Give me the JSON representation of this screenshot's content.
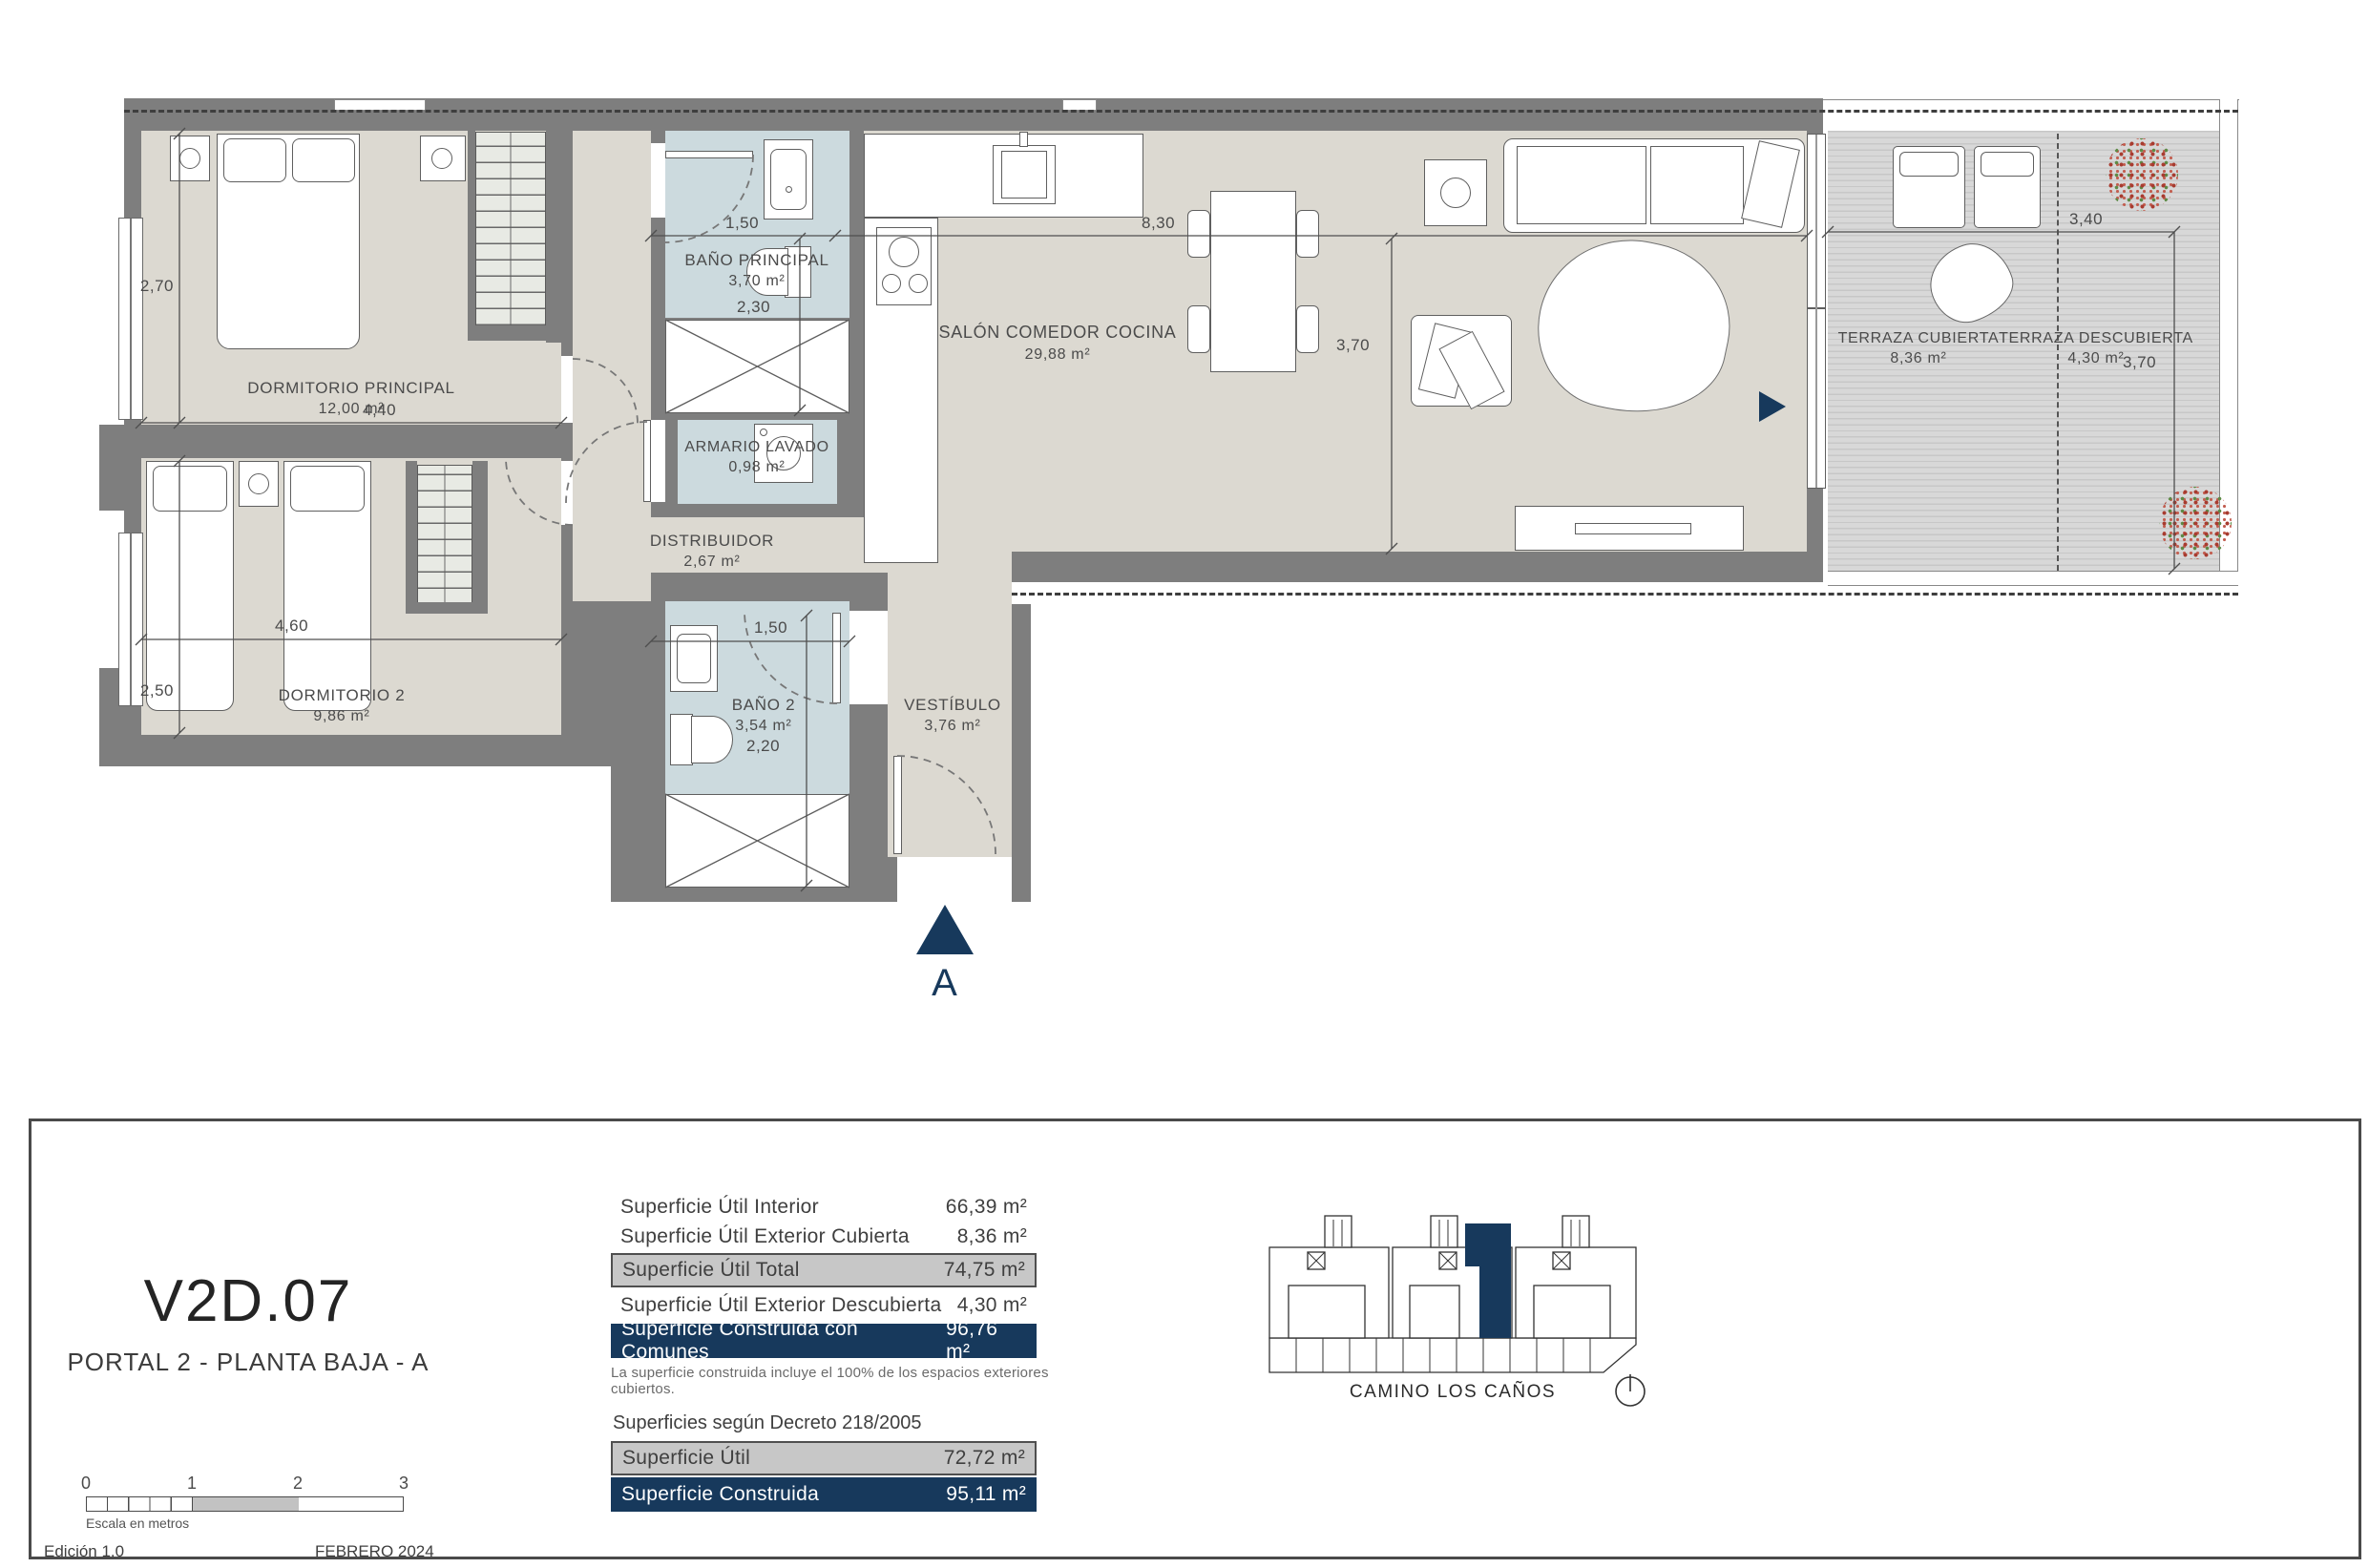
{
  "plan": {
    "rooms": {
      "dorm_principal": {
        "name": "DORMITORIO PRINCIPAL",
        "area": "12,00 m²"
      },
      "dorm2": {
        "name": "DORMITORIO 2",
        "area": "9,86 m²"
      },
      "bano_principal": {
        "name": "BAÑO PRINCIPAL",
        "area": "3,70 m²"
      },
      "bano2": {
        "name": "BAÑO 2",
        "area": "3,54 m²"
      },
      "armario_lavado": {
        "name": "ARMARIO LAVADO",
        "area": "0,98 m²"
      },
      "distribuidor": {
        "name": "DISTRIBUIDOR",
        "area": "2,67 m²"
      },
      "vestibulo": {
        "name": "VESTÍBULO",
        "area": "3,76 m²"
      },
      "salon": {
        "name": "SALÓN COMEDOR COCINA",
        "area": "29,88 m²"
      },
      "terraza_cubierta": {
        "name": "TERRAZA CUBIERTA",
        "area": "8,36 m²"
      },
      "terraza_descubierta": {
        "name": "TERRAZA DESCUBIERTA",
        "area": "4,30 m²"
      }
    },
    "dimensions": {
      "dorm1_h": "2,70",
      "dorm1_w": "4,40",
      "dorm2_w": "4,60",
      "dorm2_h": "2,50",
      "banop_w": "1,50",
      "banop_h": "2,30",
      "bano2_w": "1,50",
      "bano2_h": "2,20",
      "salon_w": "8,30",
      "salon_h": "3,70",
      "terraza_w": "3,40",
      "terraza_h": "3,70"
    },
    "entrance_label": "A"
  },
  "panel": {
    "unit_code": "V2D.07",
    "unit_subtitle": "PORTAL 2 - PLANTA BAJA - A",
    "surface_rows": [
      {
        "label": "Superficie Útil Interior",
        "value": "66,39 m²"
      },
      {
        "label": "Superficie Útil Exterior Cubierta",
        "value": "8,36 m²"
      },
      {
        "label": "Superficie Útil Total",
        "value": "74,75 m²"
      },
      {
        "label": "Superficie Útil Exterior Descubierta",
        "value": "4,30 m²"
      },
      {
        "label": "Superficie Construida con Comunes",
        "value": "96,76 m²"
      }
    ],
    "note": "La superficie construida incluye el 100% de los espacios exteriores cubiertos.",
    "decree_heading": "Superficies según Decreto 218/2005",
    "decree_rows": [
      {
        "label": "Superficie Útil",
        "value": "72,72 m²"
      },
      {
        "label": "Superficie Construida",
        "value": "95,11 m²"
      }
    ],
    "scale": {
      "ticks": [
        "0",
        "1",
        "2",
        "3"
      ],
      "caption": "Escala en metros"
    },
    "edition": "Edición 1.0",
    "date": "FEBRERO 2024",
    "street": "CAMINO LOS CAÑOS"
  },
  "colors": {
    "navy": "#17395c",
    "wall_gray": "#7e7e7e",
    "floor": "#dcd9d1",
    "bath_floor": "#ccdade",
    "row_gray": "#c7c7c7"
  }
}
